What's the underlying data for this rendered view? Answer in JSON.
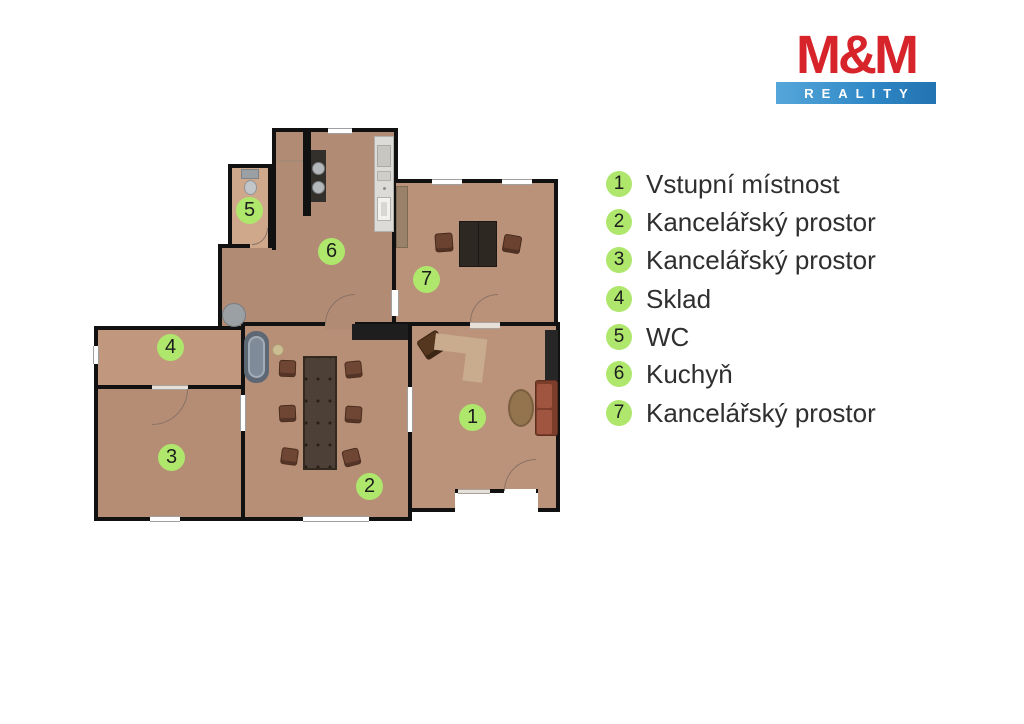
{
  "logo": {
    "brand": "M&M",
    "tagline": "REALITY",
    "colors": {
      "red": "#d7242b",
      "blue": "#3b92cc",
      "text": "#ffffff"
    }
  },
  "legend": {
    "badge_color": "#aee76c",
    "text_color": "#2f2f2f",
    "items": [
      {
        "number": "1",
        "label": "Vstupní místnost"
      },
      {
        "number": "2",
        "label": "Kancelářský prostor"
      },
      {
        "number": "3",
        "label": "Kancelářský prostor"
      },
      {
        "number": "4",
        "label": "Sklad"
      },
      {
        "number": "5",
        "label": "WC"
      },
      {
        "number": "6",
        "label": "Kuchyň"
      },
      {
        "number": "7",
        "label": "Kancelářský prostor"
      }
    ]
  },
  "plan": {
    "wall_color": "#111111",
    "floor_color": "#b78f77",
    "badge_color": "#aee76c"
  }
}
